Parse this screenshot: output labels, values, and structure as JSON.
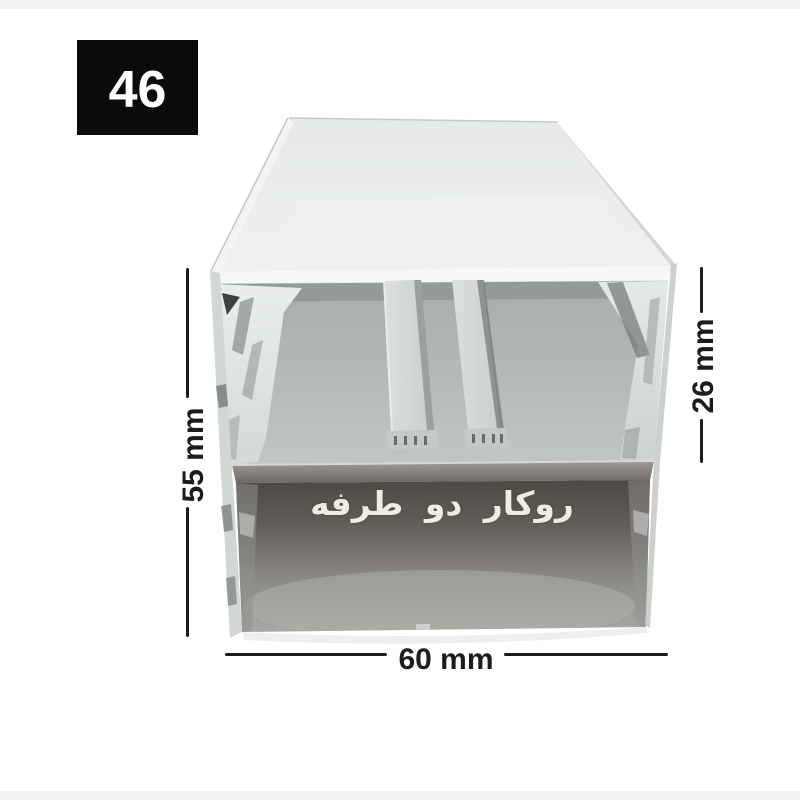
{
  "page": {
    "background_color": "#ffffff",
    "top_strip_color": "#f1f1f2",
    "bottom_strip_color": "#f2f1f2"
  },
  "badge": {
    "number": "46",
    "background_color": "#0b0b0b",
    "text_color": "#ffffff"
  },
  "product": {
    "kind": "aluminum-led-profile-photo",
    "type_label": "روکار دو طرفه",
    "type_label_color": "#f2ebe2"
  },
  "dimensions": {
    "line_color": "#1c1c1c",
    "total_height": "55 mm",
    "upper_channel_height": "26 mm",
    "width": "60 mm"
  }
}
